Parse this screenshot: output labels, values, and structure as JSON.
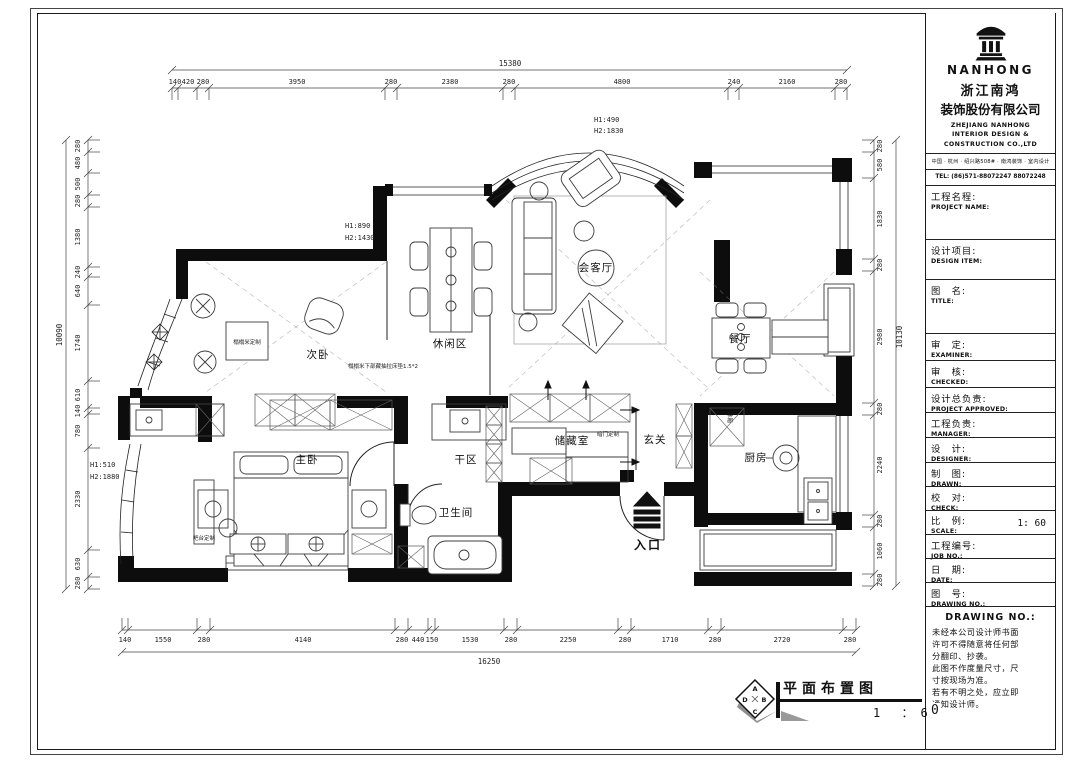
{
  "footer": {
    "title": "平面布置图",
    "scale": "1 ：6",
    "scale_zero": "0",
    "diamond": {
      "top": "A",
      "right": "B",
      "bottom": "C",
      "left": "D"
    }
  },
  "title_block": {
    "brand": "NANHONG",
    "company_cn_1": "浙江南鸿",
    "company_cn_2": "装饰股份有限公司",
    "company_en_1": "ZHEJIANG NANHONG",
    "company_en_2": "INTERIOR DESIGN &",
    "company_en_3": "CONSTRUCTION CO.,LTD",
    "address": "中国 · 杭州 · 绍兴路508# · 南鸿装饰 · 室内设计",
    "tel": "TEL: (86)571-88072247 88072248",
    "fields": [
      {
        "cn": "工程名程:",
        "en": "PROJECT NAME:",
        "value": ""
      },
      {
        "cn": "设计项目:",
        "en": "DESIGN ITEM:",
        "value": ""
      },
      {
        "cn": "图　名:",
        "en": "TITLE:",
        "value": ""
      },
      {
        "cn": "审　定:",
        "en": "EXAMINER:",
        "value": ""
      },
      {
        "cn": "审　核:",
        "en": "CHECKED:",
        "value": ""
      },
      {
        "cn": "设计总负责:",
        "en": "PROJECT APPROVED:",
        "value": ""
      },
      {
        "cn": "工程负责:",
        "en": "MANAGER:",
        "value": ""
      },
      {
        "cn": "设　计:",
        "en": "DESIGNER:",
        "value": ""
      },
      {
        "cn": "制　图:",
        "en": "DRAWN:",
        "value": ""
      },
      {
        "cn": "校　对:",
        "en": "CHECK:",
        "value": ""
      },
      {
        "cn": "比　例:",
        "en": "SCALE:",
        "value": "1: 60"
      },
      {
        "cn": "工程编号:",
        "en": "JOB NO.:",
        "value": ""
      },
      {
        "cn": "日　期:",
        "en": "DATE:",
        "value": ""
      },
      {
        "cn": "图　号:",
        "en": "DRAWING NO.:",
        "value": ""
      }
    ],
    "drawing_no_header": "DRAWING NO.:",
    "notes": [
      "未经本公司设计师书面",
      "许可不得随意将任何部",
      "分翻印、抄袭。",
      "此图不作度量尺寸，尺",
      "寸按现场为准。",
      "若有不明之处，应立即",
      "通知设计师。"
    ]
  },
  "plan": {
    "rooms": {
      "living": "会客厅",
      "leisure": "休闲区",
      "second_bedroom": "次卧",
      "dining": "餐厅",
      "kitchen": "厨房",
      "master": "主卧",
      "dry": "干区",
      "bath": "卫生间",
      "storage": "储藏室",
      "foyer": "玄关",
      "entry": "入口"
    },
    "annos": {
      "arc_h1": "H1:490",
      "arc_h2": "H2:1830",
      "win_h1": "H1:890",
      "win_h2": "H2:1430",
      "bay_h1": "H1:510",
      "bay_h2": "H2:1880",
      "tatami": "榻榻米定制",
      "tatami_note": "榻榻米下部藏抽拉床垫1.5*2",
      "bar": "吧台定制",
      "hidden_door": "暗门定制",
      "fridge": "冰箱"
    },
    "dims": {
      "top": {
        "total": "15380",
        "segments": [
          "140",
          "420",
          "280",
          "3950",
          "280",
          "2380",
          "280",
          "4800",
          "240",
          "2160",
          "280"
        ]
      },
      "bottom": {
        "total": "16250",
        "segments": [
          "140",
          "1550",
          "280",
          "4140",
          "280",
          "440",
          "150",
          "1530",
          "280",
          "2250",
          "280",
          "1710",
          "280",
          "2720",
          "280"
        ]
      },
      "left": {
        "total": "10090",
        "segments": [
          "280",
          "480",
          "500",
          "280",
          "1380",
          "240",
          "640",
          "1740",
          "610",
          "140",
          "780",
          "2330",
          "630",
          "280"
        ]
      },
      "right": {
        "total": "10130",
        "segments": [
          "280",
          "580",
          "1830",
          "280",
          "2980",
          "280",
          "2240",
          "280",
          "1060",
          "280"
        ]
      }
    }
  }
}
